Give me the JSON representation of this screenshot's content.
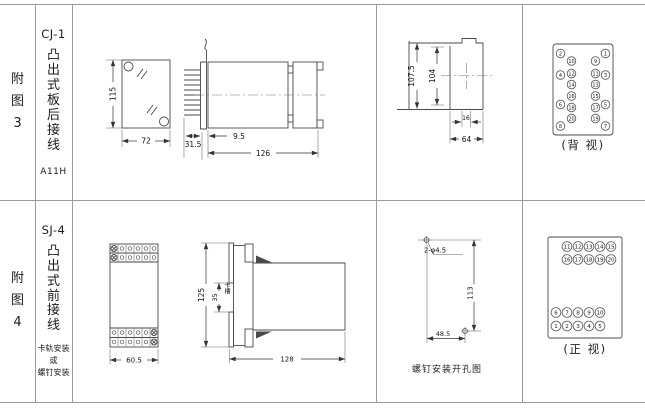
{
  "row1": {
    "fig_no": "附\n图\n3",
    "model": "CJ-1",
    "mount_type": "凸\n出\n式\n板\n后\n接\n线",
    "code": "A11H",
    "dims": {
      "front_height": "115",
      "front_width": "72",
      "pin_length": "31.5",
      "flange_offset": "9.5",
      "body_length": "126",
      "panel_outer_height": "107.5",
      "panel_inner_height": "104",
      "rail_width": "16",
      "body_width": "64"
    },
    "back_view": {
      "caption": "(背 视)",
      "outer_left": [
        "2",
        "4",
        "6",
        "8"
      ],
      "inner_left": [
        "10",
        "12",
        "14",
        "16",
        "18",
        "20"
      ],
      "inner_right": [
        "9",
        "11",
        "13",
        "15",
        "17",
        "19"
      ],
      "outer_right": [
        "1",
        "3",
        "5",
        "7"
      ]
    }
  },
  "row2": {
    "fig_no": "附\n图\n4",
    "model": "SJ-4",
    "mount_type": "凸\n出\n式\n前\n接\n线",
    "mount_note": "卡轨安装\n或\n螺钉安装",
    "dims": {
      "front_width": "60.5",
      "side_height": "125",
      "slot_height": "35",
      "slot_label": "卡槽",
      "body_length": "128",
      "hole_spec": "2-φ4.5",
      "hole_vertical": "113",
      "hole_horizontal": "48.5"
    },
    "hole_caption": "螺钉安装开孔图",
    "front_view": {
      "caption": "(正 视)",
      "rows": [
        [
          "11",
          "12",
          "13",
          "14",
          "15"
        ],
        [
          "16",
          "17",
          "18",
          "19",
          "20"
        ],
        [
          "6",
          "7",
          "8",
          "9",
          "10"
        ],
        [
          "1",
          "2",
          "3",
          "4",
          "5"
        ]
      ]
    }
  }
}
